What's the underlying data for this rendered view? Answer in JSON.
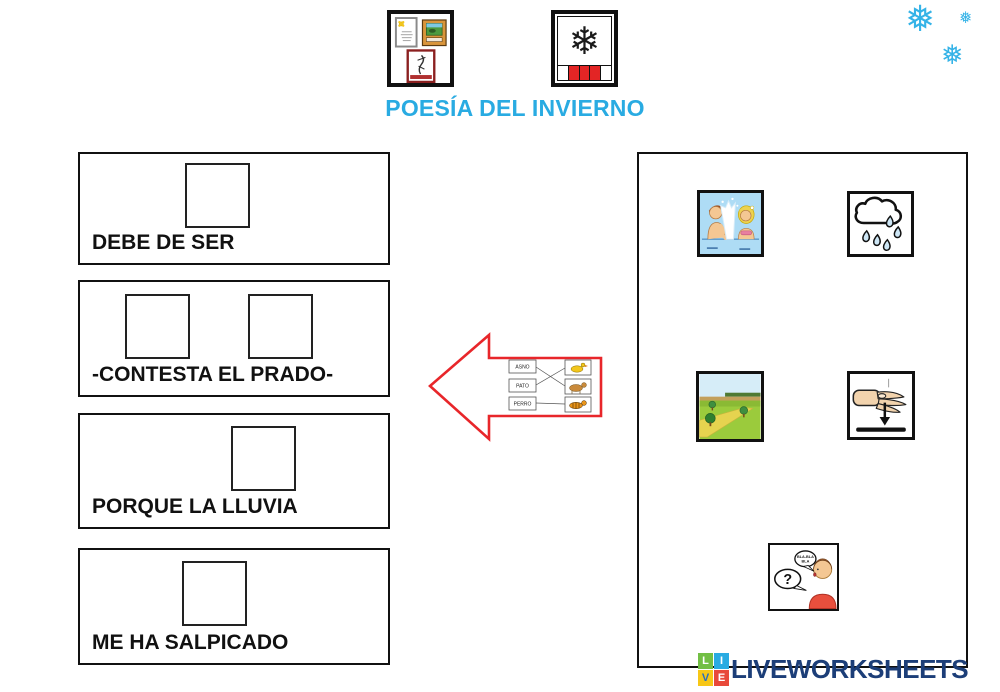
{
  "header": {
    "title": "POESÍA DEL INVIERNO",
    "title_color": "#29abe2",
    "icons": [
      {
        "name": "poesia-pictogram",
        "meaning": "poesía (framed poems on wall)"
      },
      {
        "name": "invierno-pictogram",
        "meaning": "invierno (snowflake with season calendar strip)",
        "flake_glyph": "❄"
      }
    ]
  },
  "decor": {
    "snowflake_color": "#35b3e7",
    "snowflakes": [
      {
        "glyph": "❅",
        "size": "large"
      },
      {
        "glyph": "❅",
        "size": "small"
      },
      {
        "glyph": "❅",
        "size": "medium"
      }
    ]
  },
  "phrases": [
    {
      "label": "DEBE DE SER",
      "drop_slots": 1
    },
    {
      "label": "-CONTESTA EL PRADO-",
      "drop_slots": 2
    },
    {
      "label": "PORQUE LA LLUVIA",
      "drop_slots": 1
    },
    {
      "label": "ME HA SALPICADO",
      "drop_slots": 1
    }
  ],
  "arrow": {
    "color": "#e8262a",
    "direction": "left",
    "mini_match": {
      "words": [
        "ASNO",
        "PATO",
        "PERRO"
      ]
    }
  },
  "cards": [
    {
      "name": "salpicar",
      "meaning": "children splashing water"
    },
    {
      "name": "lluvia",
      "meaning": "rain cloud with drops"
    },
    {
      "name": "prado",
      "meaning": "green meadow with path and trees"
    },
    {
      "name": "ser",
      "meaning": "hand pointing down to a line"
    },
    {
      "name": "contestar",
      "meaning": "boy answering with speech bubbles",
      "bubble_question": "?",
      "bubble_bla_line1": "BLA-BLA",
      "bubble_bla_line2": "BLA"
    }
  ],
  "footer": {
    "logo_text": "LIVEWORKSHEETS",
    "logo_text_color": "#1c3e78",
    "logo_squares": [
      {
        "letter": "L",
        "bg": "#72bf44"
      },
      {
        "letter": "I",
        "bg": "#29abe2"
      },
      {
        "letter": "V",
        "bg": "#f7c716"
      },
      {
        "letter": "E",
        "bg": "#e8493a"
      }
    ]
  }
}
